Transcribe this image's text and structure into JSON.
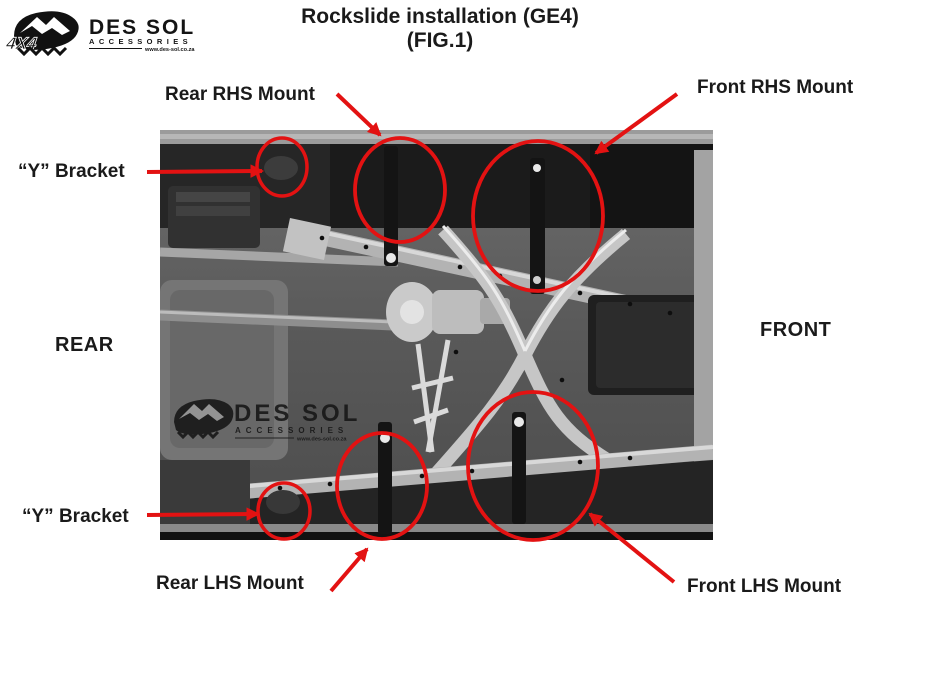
{
  "colors": {
    "annotation_red": "#e31212",
    "text": "#1a1a1a"
  },
  "logo": {
    "brand": "DES SOL",
    "tagline": "ACCESSORIES",
    "website": "www.des-sol.co.za",
    "emblem": "4x4-mountain-logo"
  },
  "title": {
    "line1": "Rockslide installation (GE4)",
    "line2": "(FIG.1)"
  },
  "labels": {
    "rear_rhs_mount": "Rear RHS Mount",
    "front_rhs_mount": "Front RHS Mount",
    "y_bracket_top": "“Y” Bracket",
    "rear": "REAR",
    "front": "FRONT",
    "y_bracket_bottom": "“Y” Bracket",
    "rear_lhs_mount": "Rear LHS Mount",
    "front_lhs_mount": "Front LHS Mount"
  },
  "photo": {
    "description": "grayscale underbody photo of vehicle with rockslider rails",
    "watermark_brand": "DES SOL",
    "watermark_tagline": "ACCESSORIES",
    "watermark_website": "www.des-sol.co.za"
  }
}
